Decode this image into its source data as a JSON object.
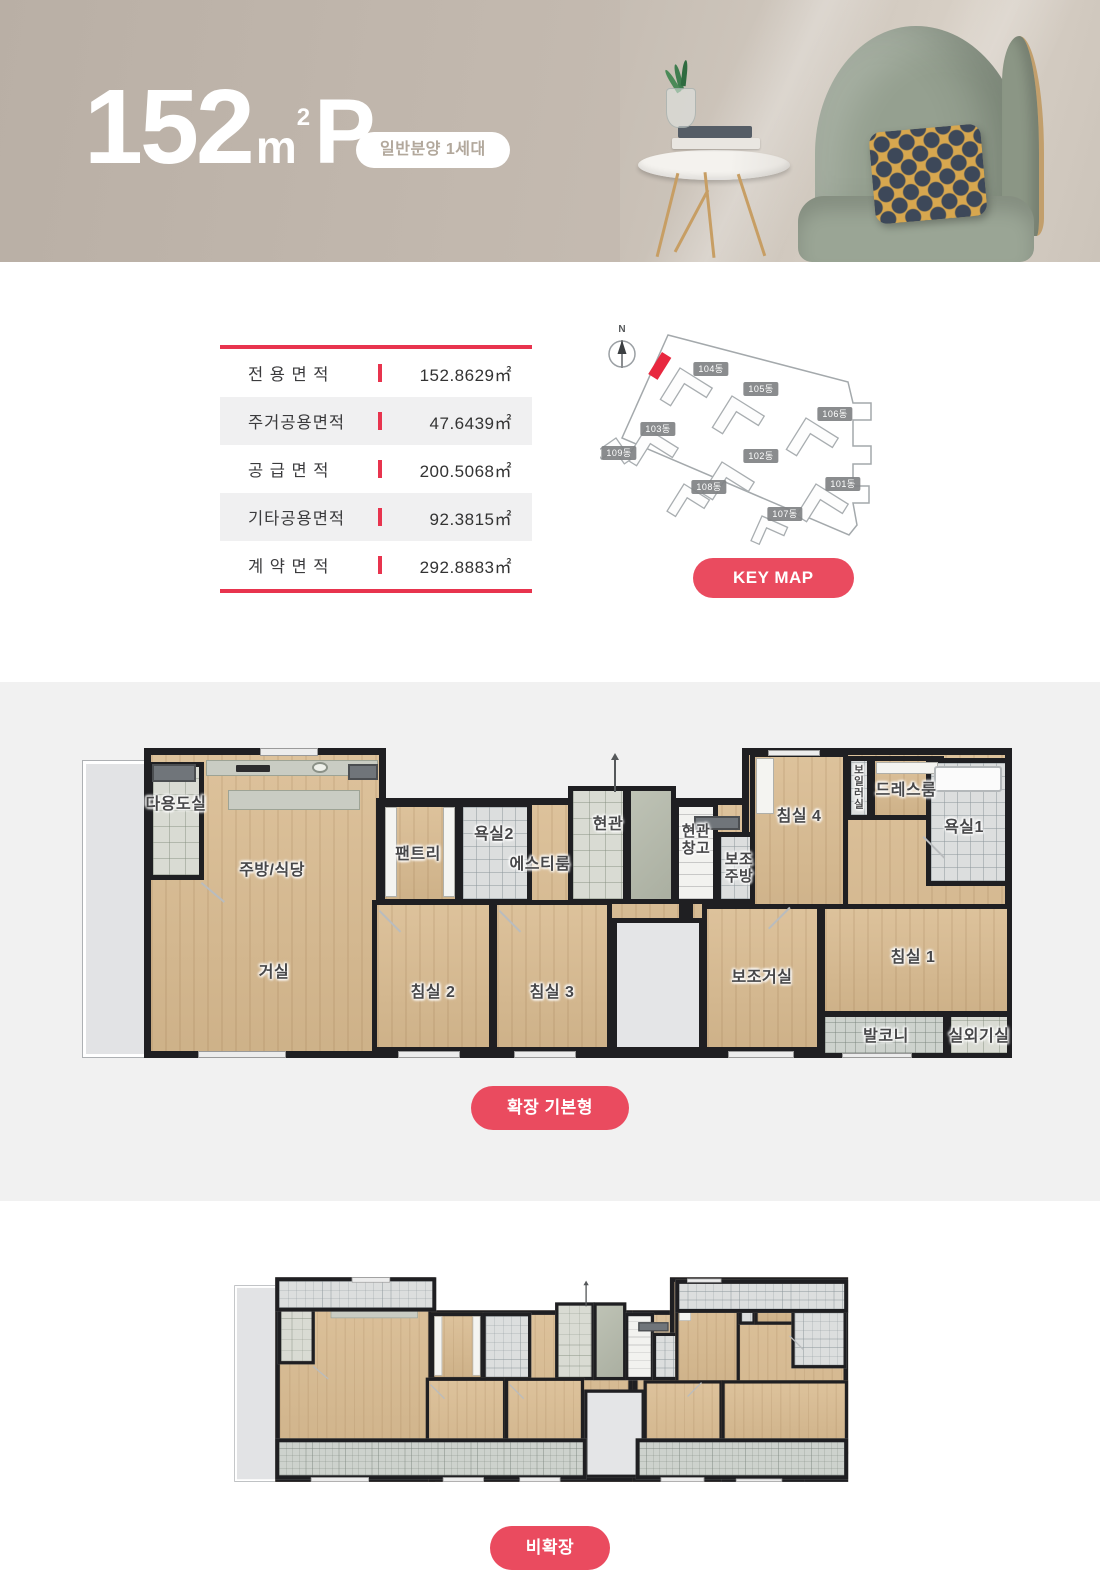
{
  "theme": {
    "accent": "#ea4b5f",
    "accent_dark": "#e8344e",
    "header_bg": "#bcb2a8",
    "wall": "#1f1f22",
    "section_bg": "#f1f1f1",
    "keymap_highlight": "#e8283f"
  },
  "header": {
    "title_number": "152",
    "title_unit": "m",
    "title_sup": "2",
    "title_suffix": "P",
    "badge": "일반분양 1세대"
  },
  "area_table": {
    "rows": [
      {
        "label": "전 용 면 적",
        "value": "152.8629㎡"
      },
      {
        "label": "주거공용면적",
        "value": "47.6439㎡"
      },
      {
        "label": "공 급 면 적",
        "value": "200.5068㎡"
      },
      {
        "label": "기타공용면적",
        "value": "92.3815㎡"
      },
      {
        "label": "계 약 면 적",
        "value": "292.8883㎡"
      }
    ]
  },
  "keymap": {
    "compass_label": "N",
    "button_label": "KEY MAP",
    "buildings": [
      {
        "label": "104동"
      },
      {
        "label": "105동"
      },
      {
        "label": "106동"
      },
      {
        "label": "103동"
      },
      {
        "label": "109동"
      },
      {
        "label": "102동"
      },
      {
        "label": "108동"
      },
      {
        "label": "101동"
      },
      {
        "label": "107동"
      }
    ]
  },
  "floor_plans": {
    "expanded": {
      "button_label": "확장 기본형",
      "rooms": {
        "utility": "다용도실",
        "kitchen_dining": "주방/식당",
        "pantry": "팬트리",
        "bath2": "욕실2",
        "st_room": "에스티룸",
        "entrance": "현관",
        "entrance_storage": "현관창고",
        "aux_kitchen": "보조주방",
        "bed4": "침실 4",
        "boiler": "보일러실",
        "dress": "드레스룸",
        "bath1": "욕실1",
        "living": "거실",
        "bed2": "침실 2",
        "bed3": "침실 3",
        "aux_living": "보조거실",
        "bed1": "침실 1",
        "balcony": "발코니",
        "ac_room": "실외기실"
      }
    },
    "collapsed": {
      "button_label": "비확장"
    }
  }
}
